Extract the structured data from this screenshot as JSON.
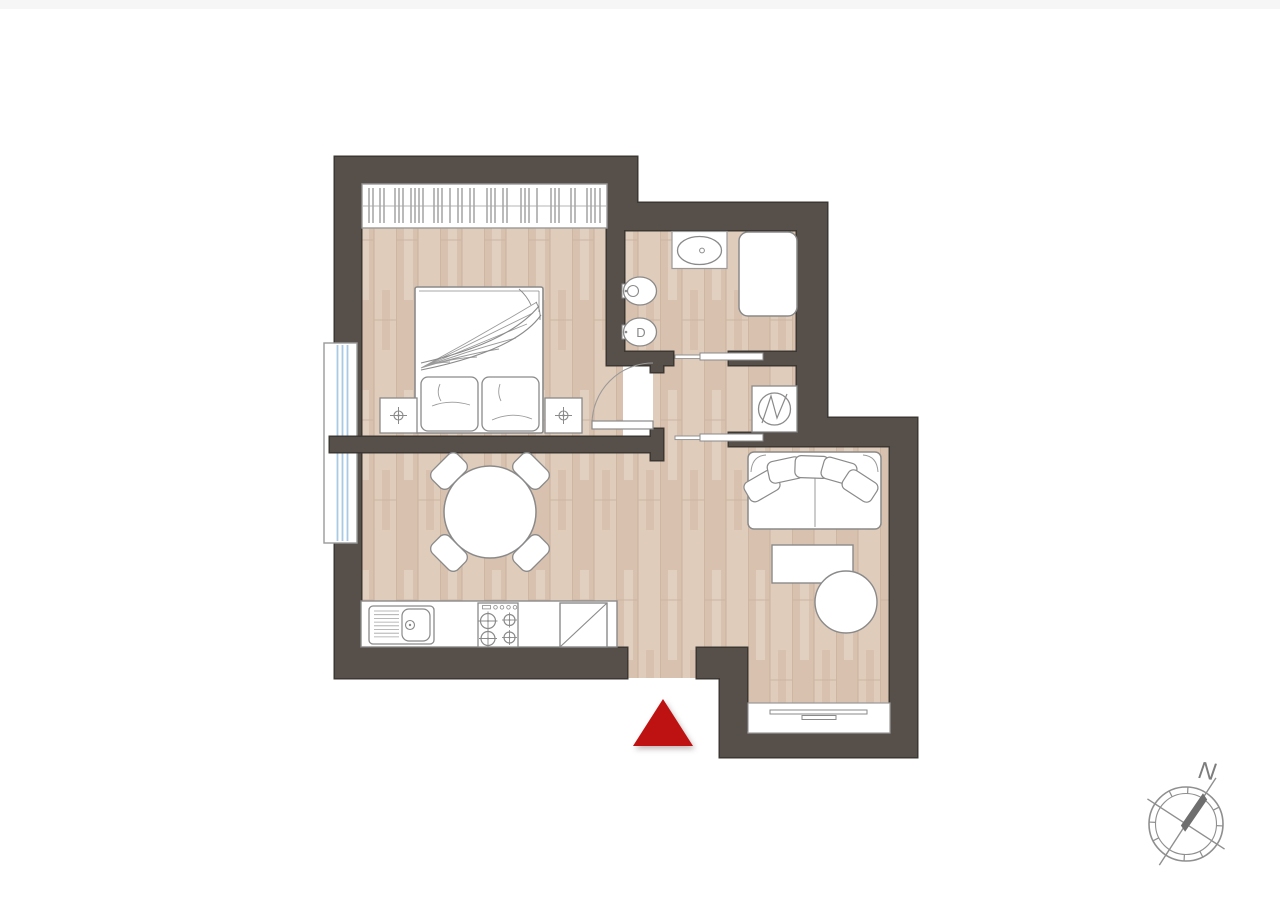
{
  "floorplan": {
    "compass": {
      "north_label": "N"
    },
    "bathroom": {
      "toilet_label": "D"
    },
    "colors": {
      "wall_fill": "#57504A",
      "wall_outline": "#3B3732",
      "floor_base": "#DCC7B5",
      "floor_plank_line": "#C9B19E",
      "fixture_outline": "#8A8A8A",
      "fixture_line_light": "#9A9A9A",
      "window_frame": "#9A9A9A",
      "window_glass_blue": "#A9C9E4",
      "entrance_marker_red": "#BE1212",
      "compass_gray": "#8F8F8F",
      "compass_needle": "#6E6E6E",
      "page_edge": "#F6F6F6"
    },
    "elements": [
      "wardrobe",
      "double-bed",
      "nightstand-left",
      "nightstand-right",
      "french-window-left",
      "bathroom-sink",
      "shower",
      "bidet",
      "toilet",
      "sliding-door-bathroom",
      "sliding-door-hall",
      "bedroom-door",
      "washing-machine",
      "kitchen-counter",
      "kitchen-sink",
      "stove",
      "fridge",
      "dining-table",
      "dining-chairs",
      "sofa",
      "desk",
      "pouf-chair",
      "window-bottom",
      "entrance-marker",
      "compass-rose"
    ]
  }
}
